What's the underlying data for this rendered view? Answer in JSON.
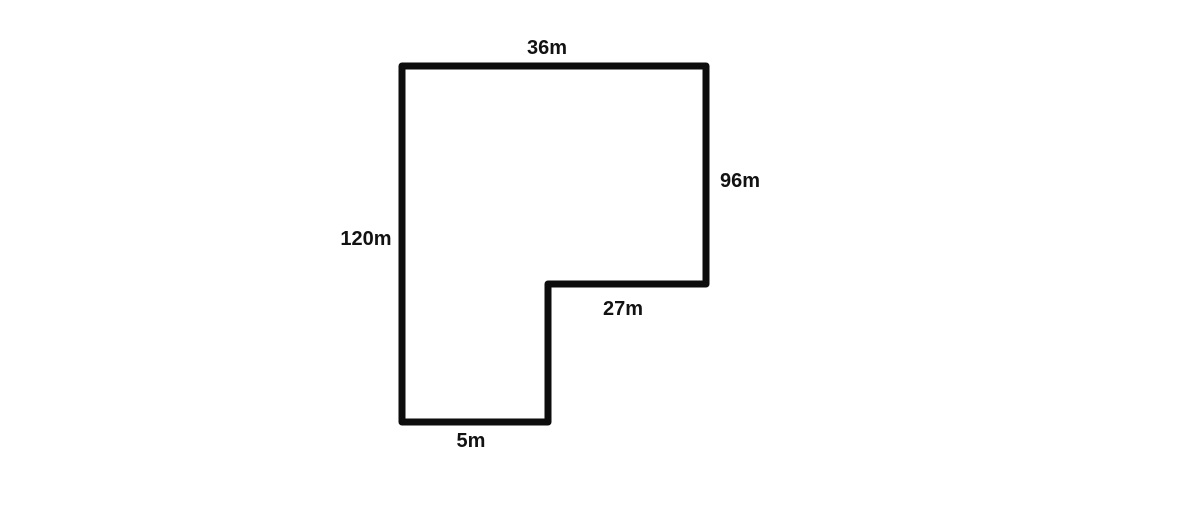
{
  "diagram": {
    "type": "polygon-outline",
    "description": "L-shaped plot with labeled side lengths",
    "background": "#ffffff",
    "stroke_color": "#0d0d0d",
    "stroke_width": 7,
    "vertices": [
      [
        402,
        66
      ],
      [
        706,
        66
      ],
      [
        706,
        284
      ],
      [
        548,
        284
      ],
      [
        548,
        422
      ],
      [
        402,
        422
      ]
    ],
    "labels": [
      {
        "edge": "top-width",
        "text": "36m",
        "x": 547,
        "y": 48
      },
      {
        "edge": "right-height",
        "text": "96m",
        "x": 740,
        "y": 181
      },
      {
        "edge": "left-height",
        "text": "120m",
        "x": 366,
        "y": 239
      },
      {
        "edge": "inner-width",
        "text": "27m",
        "x": 623,
        "y": 309
      },
      {
        "edge": "bottom-width",
        "text": "5m",
        "x": 471,
        "y": 441
      }
    ]
  }
}
